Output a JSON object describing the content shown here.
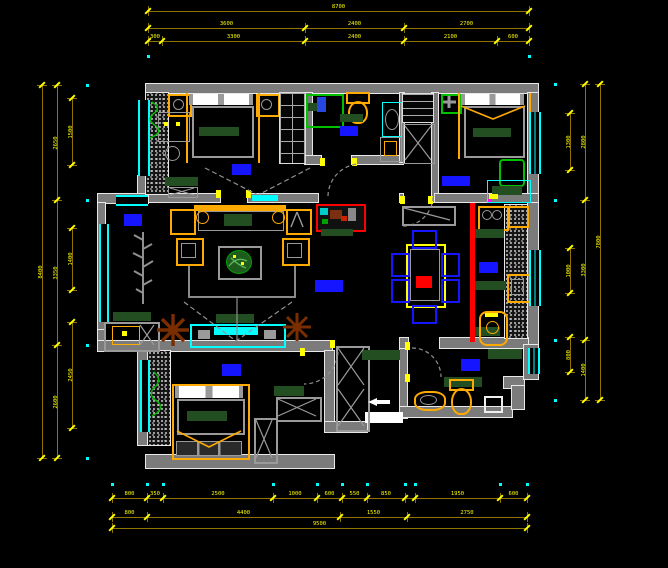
{
  "drawing": {
    "kind": "apartment floor plan",
    "palette": {
      "background": "#000000",
      "wall_gray": "#7B7B7B",
      "edge_white": "#E8E8E8",
      "window_cyan": "#00FFFF",
      "furniture_orange": "#FFAA00",
      "furniture_green_dark": "#224E22",
      "fixture_green_bright": "#00C000",
      "chair_blue": "#1515FF",
      "label_blue": "#1515FF",
      "accent_red": "#FF0000",
      "plant_brown": "#7A2E00",
      "dim_line_gold": "#8F7400",
      "dim_text_yellow": "#FFFF00"
    }
  },
  "dimensions": {
    "line_color": "#8F7400",
    "tick_color": "#FFFF00",
    "text_color": "#FFFF00",
    "ext_dot_color": "#00FFFF",
    "h_rows": [
      {
        "y": 11,
        "ext_y": 56,
        "segments": [
          {
            "x1": 148,
            "x2": 529,
            "label": "8700"
          }
        ]
      },
      {
        "y": 28,
        "segments": [
          {
            "x1": 148,
            "x2": 305,
            "label": "3600"
          },
          {
            "x1": 305,
            "x2": 404,
            "label": "2400"
          },
          {
            "x1": 404,
            "x2": 529,
            "label": "2700"
          }
        ]
      },
      {
        "y": 41,
        "segments": [
          {
            "x1": 148,
            "x2": 162,
            "label": "300"
          },
          {
            "x1": 162,
            "x2": 305,
            "label": "3300"
          },
          {
            "x1": 305,
            "x2": 404,
            "label": "2400"
          },
          {
            "x1": 404,
            "x2": 497,
            "label": "2100"
          },
          {
            "x1": 497,
            "x2": 529,
            "label": "600"
          }
        ]
      },
      {
        "y": 498,
        "ext_y": 484,
        "segments": [
          {
            "x1": 112,
            "x2": 147,
            "label": "800"
          },
          {
            "x1": 147,
            "x2": 163,
            "label": "350"
          },
          {
            "x1": 163,
            "x2": 273,
            "label": "2500"
          },
          {
            "x1": 273,
            "x2": 317,
            "label": "1000"
          },
          {
            "x1": 317,
            "x2": 342,
            "label": "600"
          },
          {
            "x1": 342,
            "x2": 367,
            "label": "550"
          },
          {
            "x1": 367,
            "x2": 405,
            "label": "850"
          },
          {
            "x1": 405,
            "x2": 415,
            "label": ""
          },
          {
            "x1": 415,
            "x2": 500,
            "label": "1950"
          },
          {
            "x1": 500,
            "x2": 527,
            "label": "600"
          }
        ]
      },
      {
        "y": 517,
        "segments": [
          {
            "x1": 112,
            "x2": 147,
            "label": "800"
          },
          {
            "x1": 147,
            "x2": 340,
            "label": "4400"
          },
          {
            "x1": 340,
            "x2": 407,
            "label": "1550"
          },
          {
            "x1": 407,
            "x2": 527,
            "label": "2750"
          }
        ]
      },
      {
        "y": 528,
        "segments": [
          {
            "x1": 112,
            "x2": 527,
            "label": "9500"
          }
        ]
      }
    ],
    "v_cols": [
      {
        "x": 42,
        "segments": [
          {
            "y1": 85,
            "y2": 458,
            "label": "8400"
          }
        ]
      },
      {
        "x": 57,
        "ext_x": 87,
        "segments": [
          {
            "y1": 85,
            "y2": 200,
            "label": "2650"
          },
          {
            "y1": 200,
            "y2": 345,
            "label": "3350"
          },
          {
            "y1": 345,
            "y2": 458,
            "label": "2600"
          }
        ]
      },
      {
        "x": 72,
        "segments": [
          {
            "y1": 98,
            "y2": 165,
            "label": "1500"
          },
          {
            "y1": 228,
            "y2": 290,
            "label": "1400"
          },
          {
            "y1": 322,
            "y2": 428,
            "label": "2450"
          }
        ]
      },
      {
        "x": 570,
        "segments": [
          {
            "y1": 113,
            "y2": 170,
            "label": "1300"
          },
          {
            "y1": 248,
            "y2": 293,
            "label": "1000"
          },
          {
            "y1": 337,
            "y2": 372,
            "label": "800"
          }
        ]
      },
      {
        "x": 585,
        "ext_x": 555,
        "segments": [
          {
            "y1": 84,
            "y2": 200,
            "label": "2800"
          },
          {
            "y1": 200,
            "y2": 340,
            "label": "3300"
          },
          {
            "y1": 340,
            "y2": 400,
            "label": "1400"
          }
        ]
      },
      {
        "x": 600,
        "segments": [
          {
            "y1": 84,
            "y2": 400,
            "label": "7800"
          }
        ]
      }
    ]
  }
}
